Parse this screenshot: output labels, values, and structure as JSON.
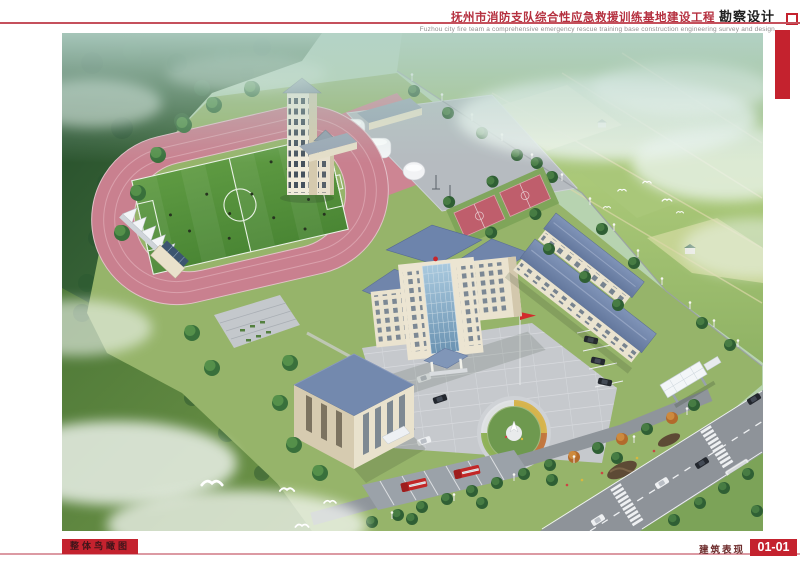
{
  "header": {
    "title_cn": "抚州市消防支队综合性应急救援训练基地建设工程",
    "title_suffix": "勘察设计",
    "subtitle_en": "Fuzhou city fire team a comprehensive emergency rescue training base construction engineering survey and design"
  },
  "footer": {
    "sheet_label": "整体鸟瞰图",
    "category_label": "建筑表现",
    "sheet_number": "01-01"
  },
  "colors": {
    "accent_red": "#c4222e",
    "rule_pink": "#dc9aa3",
    "title_red": "#b5303f",
    "track_pink": "#c9808f",
    "field_green": "#54913a",
    "roof_blue": "#7085ab",
    "wall_cream": "#eae3cf",
    "fire_truck_red": "#c22727"
  },
  "scene": {
    "type": "aerial-architectural-rendering",
    "subject": "fire-rescue-training-base",
    "elements": [
      "forest-hills",
      "farmland",
      "running-track",
      "soccer-field",
      "grandstand-tents",
      "training-tower",
      "storage-tanks",
      "boundary-fence",
      "basketball-courts",
      "main-office-building",
      "dormitory-buildings",
      "training-building",
      "flag-plaza",
      "circular-garden",
      "flagpole",
      "parked-cars",
      "fire-truck-parking",
      "fire-trucks",
      "entrance-gate",
      "public-road",
      "crosswalks",
      "bus",
      "clouds",
      "birds"
    ]
  }
}
